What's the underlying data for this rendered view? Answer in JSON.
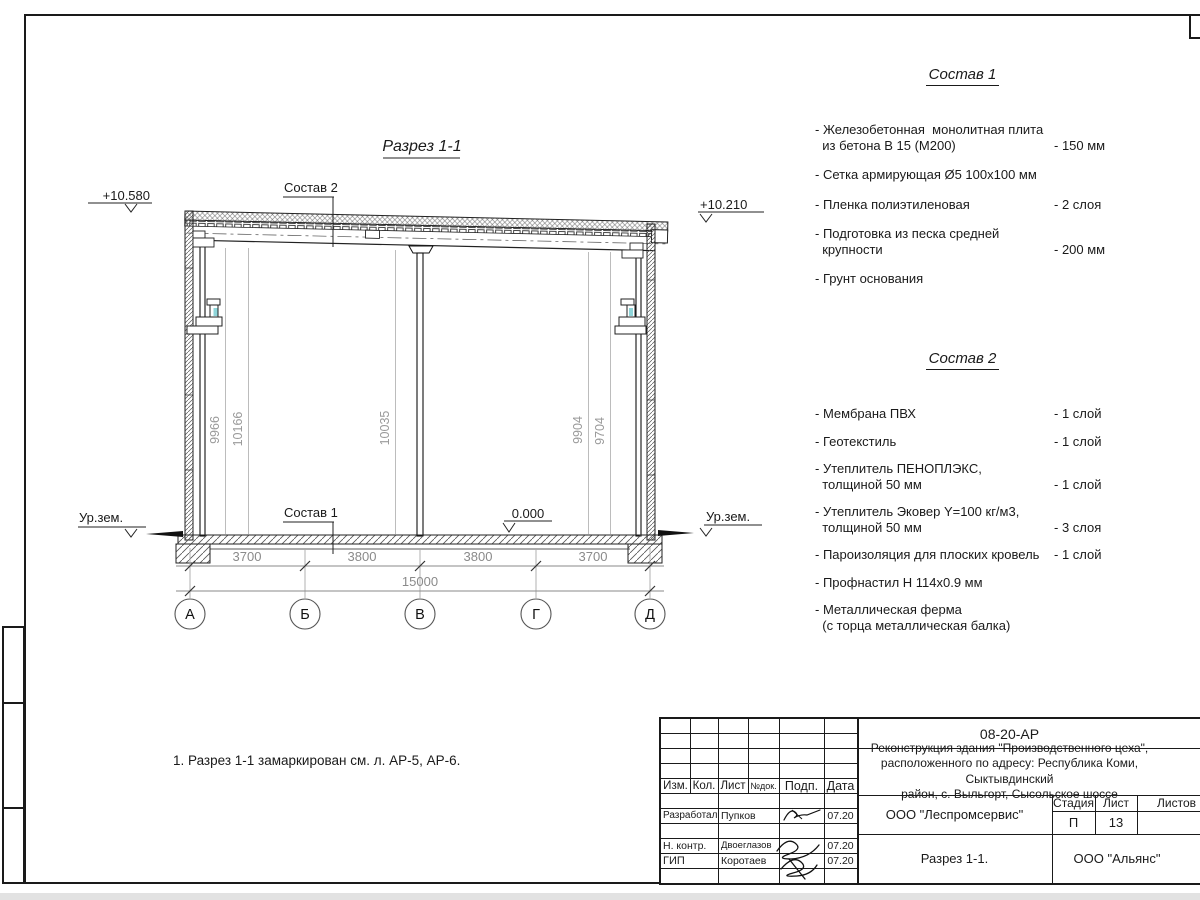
{
  "drawing": {
    "title": "Разрез 1-1",
    "note": "1. Разрез 1-1 замаркирован см. л. АР-5, АР-6.",
    "labels": {
      "comp2_ref": "Состав 2",
      "comp1_ref": "Состав 1"
    },
    "elevations": {
      "roof_left": "+10.580",
      "roof_right": "+10.210",
      "floor": "0.000",
      "ground_left": "Ур.зем.",
      "ground_right": "Ур.зем."
    },
    "axis_bubbles": [
      "А",
      "Б",
      "В",
      "Г",
      "Д"
    ],
    "dims_bottom": [
      "3700",
      "3800",
      "3800",
      "3700"
    ],
    "dim_total": "15000",
    "dims_height": [
      "9966",
      "10166",
      "10035",
      "9904",
      "9704"
    ],
    "accent_color": "#8fd6da"
  },
  "composition1": {
    "title": "Состав 1",
    "items": [
      {
        "name": "- Железобетонная  монолитная плита\n  из бетона В 15 (М200)",
        "value": "- 150 мм"
      },
      {
        "name": "- Сетка армирующая Ø5 100х100 мм",
        "value": ""
      },
      {
        "name": "- Пленка полиэтиленовая",
        "value": "-  2 слоя"
      },
      {
        "name": "- Подготовка из песка средней\n  крупности",
        "value": "- 200 мм"
      },
      {
        "name": "- Грунт основания",
        "value": ""
      }
    ]
  },
  "composition2": {
    "title": "Состав 2",
    "items": [
      {
        "name": "- Мембрана ПВХ",
        "value": "- 1 слой"
      },
      {
        "name": "- Геотекстиль",
        "value": "- 1 слой"
      },
      {
        "name": "- Утеплитель ПЕНОПЛЭКС,\n  толщиной 50 мм",
        "value": "- 1 слой"
      },
      {
        "name": "- Утеплитель Эковер Y=100 кг/м3,\n  толщиной 50 мм",
        "value": "- 3 слоя"
      },
      {
        "name": "- Пароизоляция для плоских кровель",
        "value": "- 1 слой"
      },
      {
        "name": "- Профнастил Н 114х0.9 мм",
        "value": ""
      },
      {
        "name": "- Металлическая ферма\n  (с торца металлическая балка)",
        "value": ""
      }
    ]
  },
  "titleblock": {
    "doc_code": "08-20-АР",
    "project_name": "Реконструкция здания \"Производственного цеха\",\nрасположенного по адресу: Республика Коми, Сыктывдинский\nрайон, с. Выльгорт, Сысольское шоссе",
    "columns": {
      "izm": "Изм.",
      "kol": "Кол.",
      "list": "Лист",
      "ndok": "№док.",
      "podp": "Подп.",
      "data": "Дата"
    },
    "rows": [
      {
        "role": "Разработал",
        "name": "Пупков",
        "date": "07.20"
      },
      {
        "role": "Н. контр.",
        "name": "Двоеглазов",
        "date": "07.20"
      },
      {
        "role": "ГИП",
        "name": "Коротаев",
        "date": "07.20"
      }
    ],
    "org": "ООО \"Леспромсервис\"",
    "stage_label": "Стадия",
    "sheet_label": "Лист",
    "sheets_label": "Листов",
    "stage": "П",
    "sheet_num": "13",
    "sheets_total": "",
    "sheet_name": "Разрез 1-1.",
    "contractor": "ООО \"Альянс\""
  }
}
